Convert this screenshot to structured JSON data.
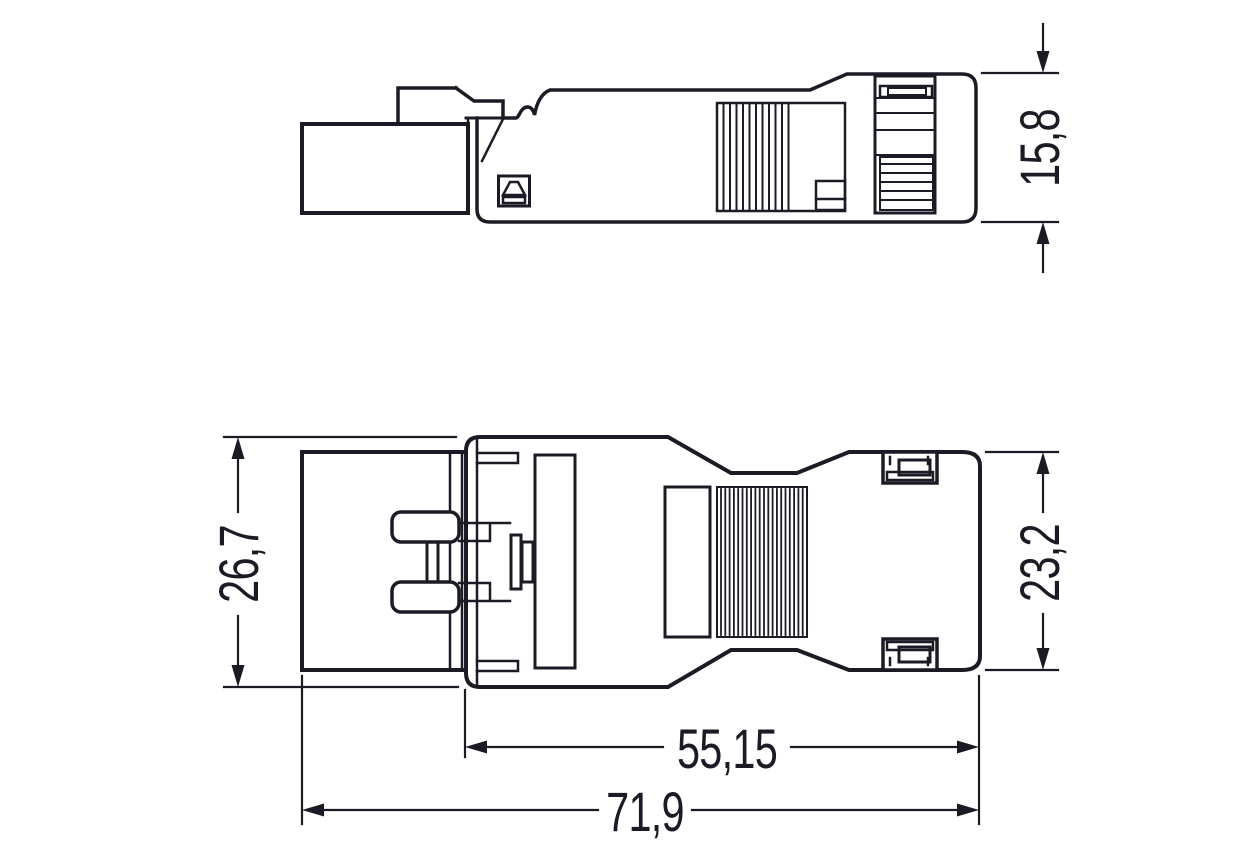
{
  "drawing": {
    "background_color": "#ffffff",
    "line_color": "#1b1b26",
    "views": [
      {
        "id": "side-view",
        "description": "connector side elevation (upper view)"
      },
      {
        "id": "top-view",
        "description": "connector top view with contact pins (lower view)"
      }
    ],
    "dimensions": {
      "side_height": {
        "label": "15,8",
        "view": "side-view",
        "orientation": "vertical"
      },
      "hood_width": {
        "label": "26,7",
        "view": "top-view",
        "orientation": "vertical"
      },
      "rear_width": {
        "label": "23,2",
        "view": "top-view",
        "orientation": "vertical"
      },
      "housing_length": {
        "label": "55,15",
        "view": "top-view",
        "orientation": "horizontal"
      },
      "total_length": {
        "label": "71,9",
        "view": "top-view",
        "orientation": "horizontal"
      }
    }
  }
}
